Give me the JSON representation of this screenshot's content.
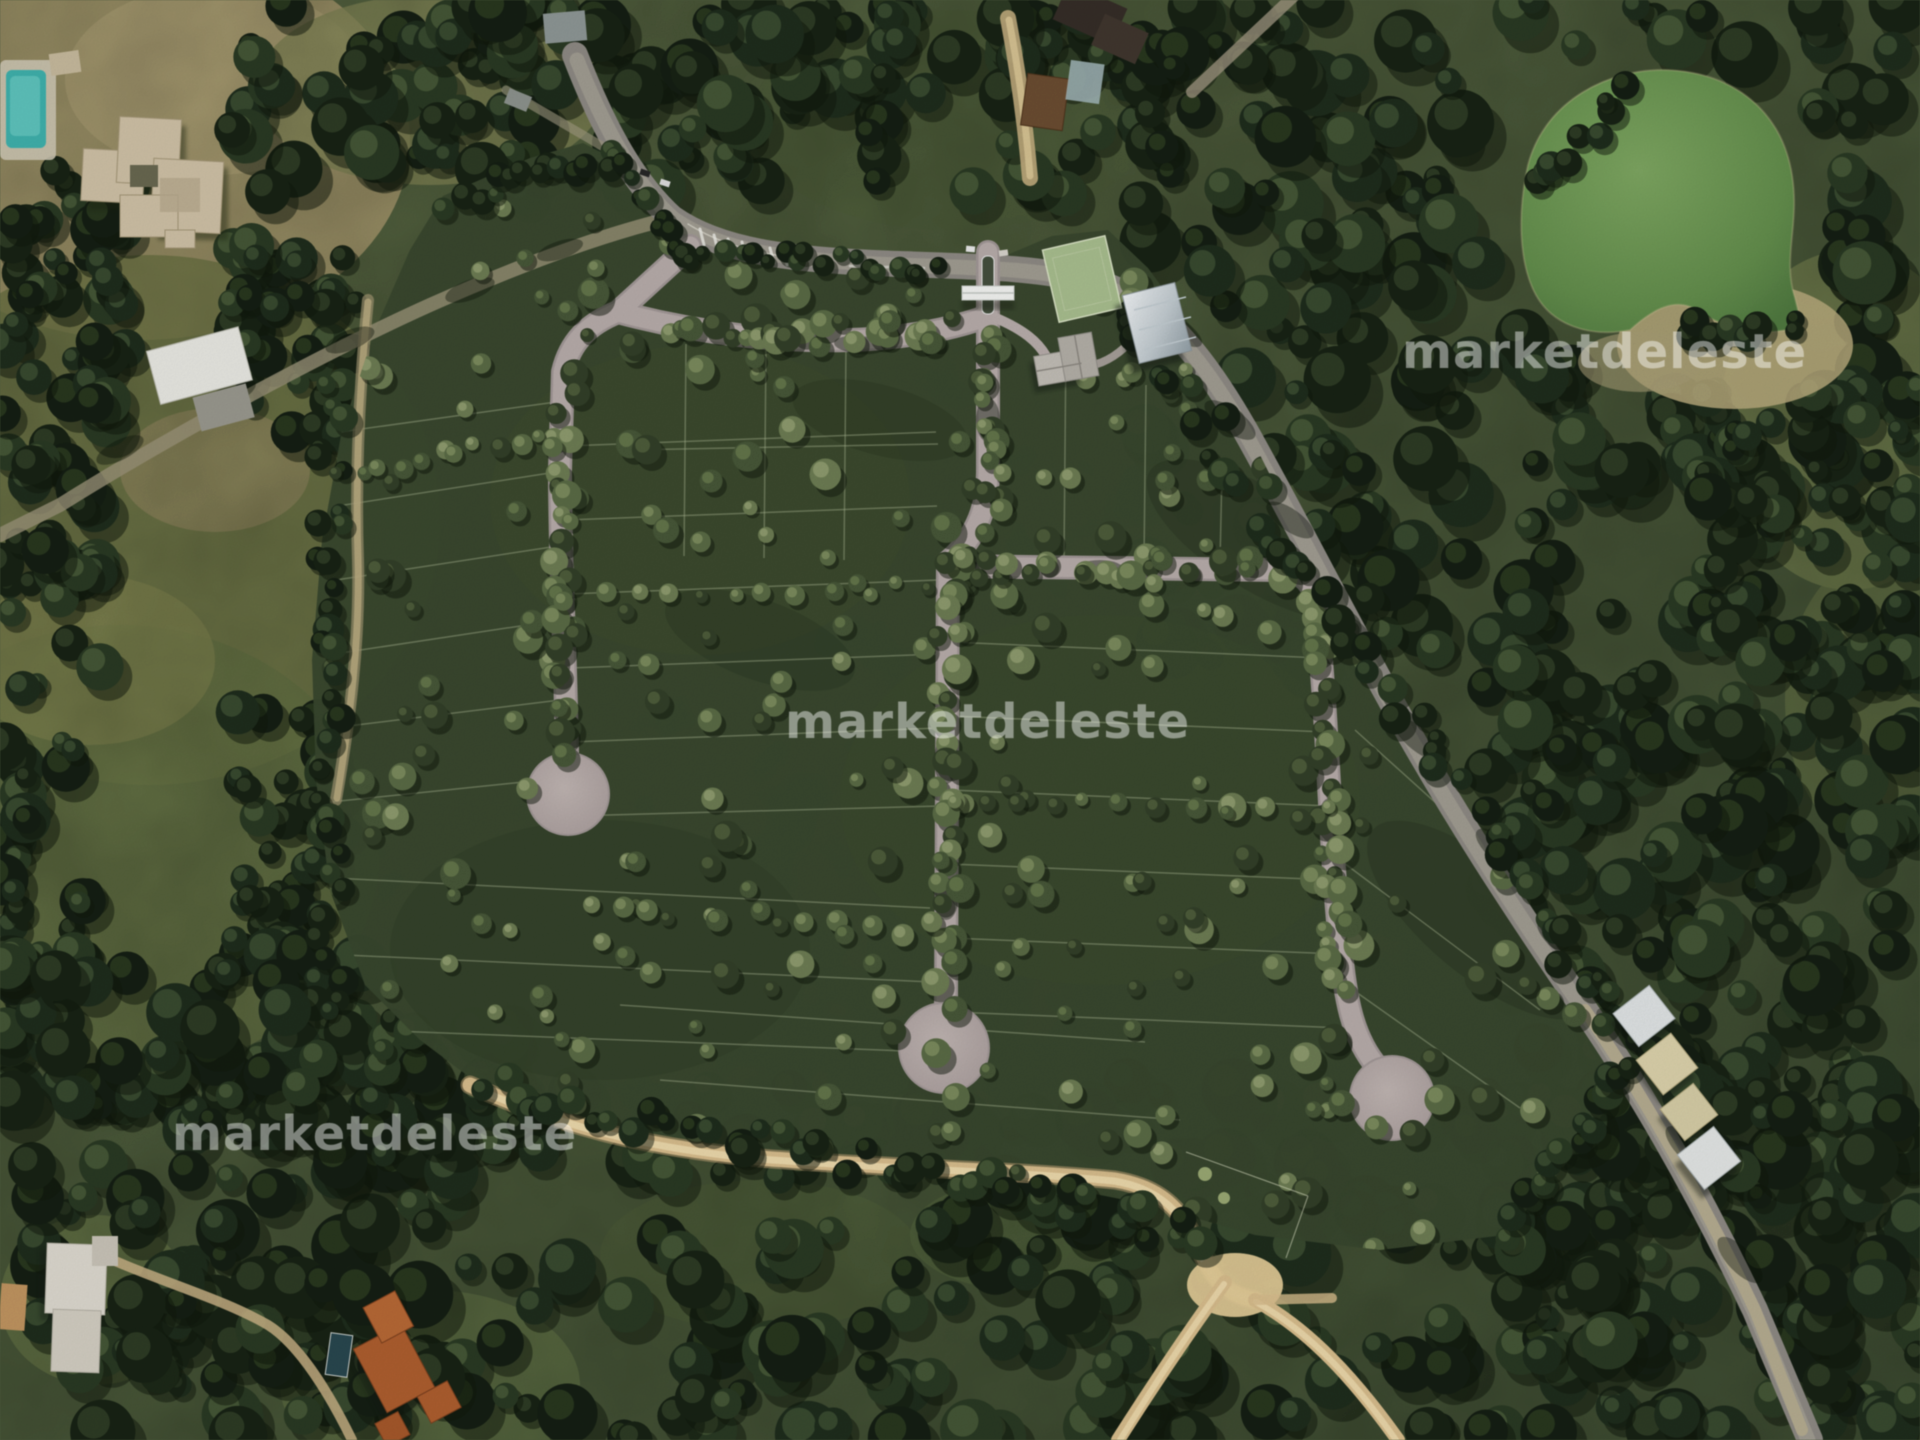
{
  "image": {
    "kind": "aerial-satellite-photo",
    "caption": "Satellite master plan of a wooded land subdivision with internal roads, three cul-de-sacs, entrance gate, clubhouse, sports field and a green pond"
  },
  "watermark": {
    "text": "marketdeleste",
    "occurrences": 3
  },
  "colors": {
    "development_green": "#3b4a31",
    "forest_dark": "#1d2a1a",
    "field_green": "#7b834f",
    "dry_lawn": "#ad9f72",
    "internal_road": "#b8adab",
    "public_road": "#918b82",
    "dirt_road": "#d8bd8c",
    "pond_green": "#6e9857",
    "lot_line": "#a9b591",
    "watermark_white": "#ffffff"
  }
}
